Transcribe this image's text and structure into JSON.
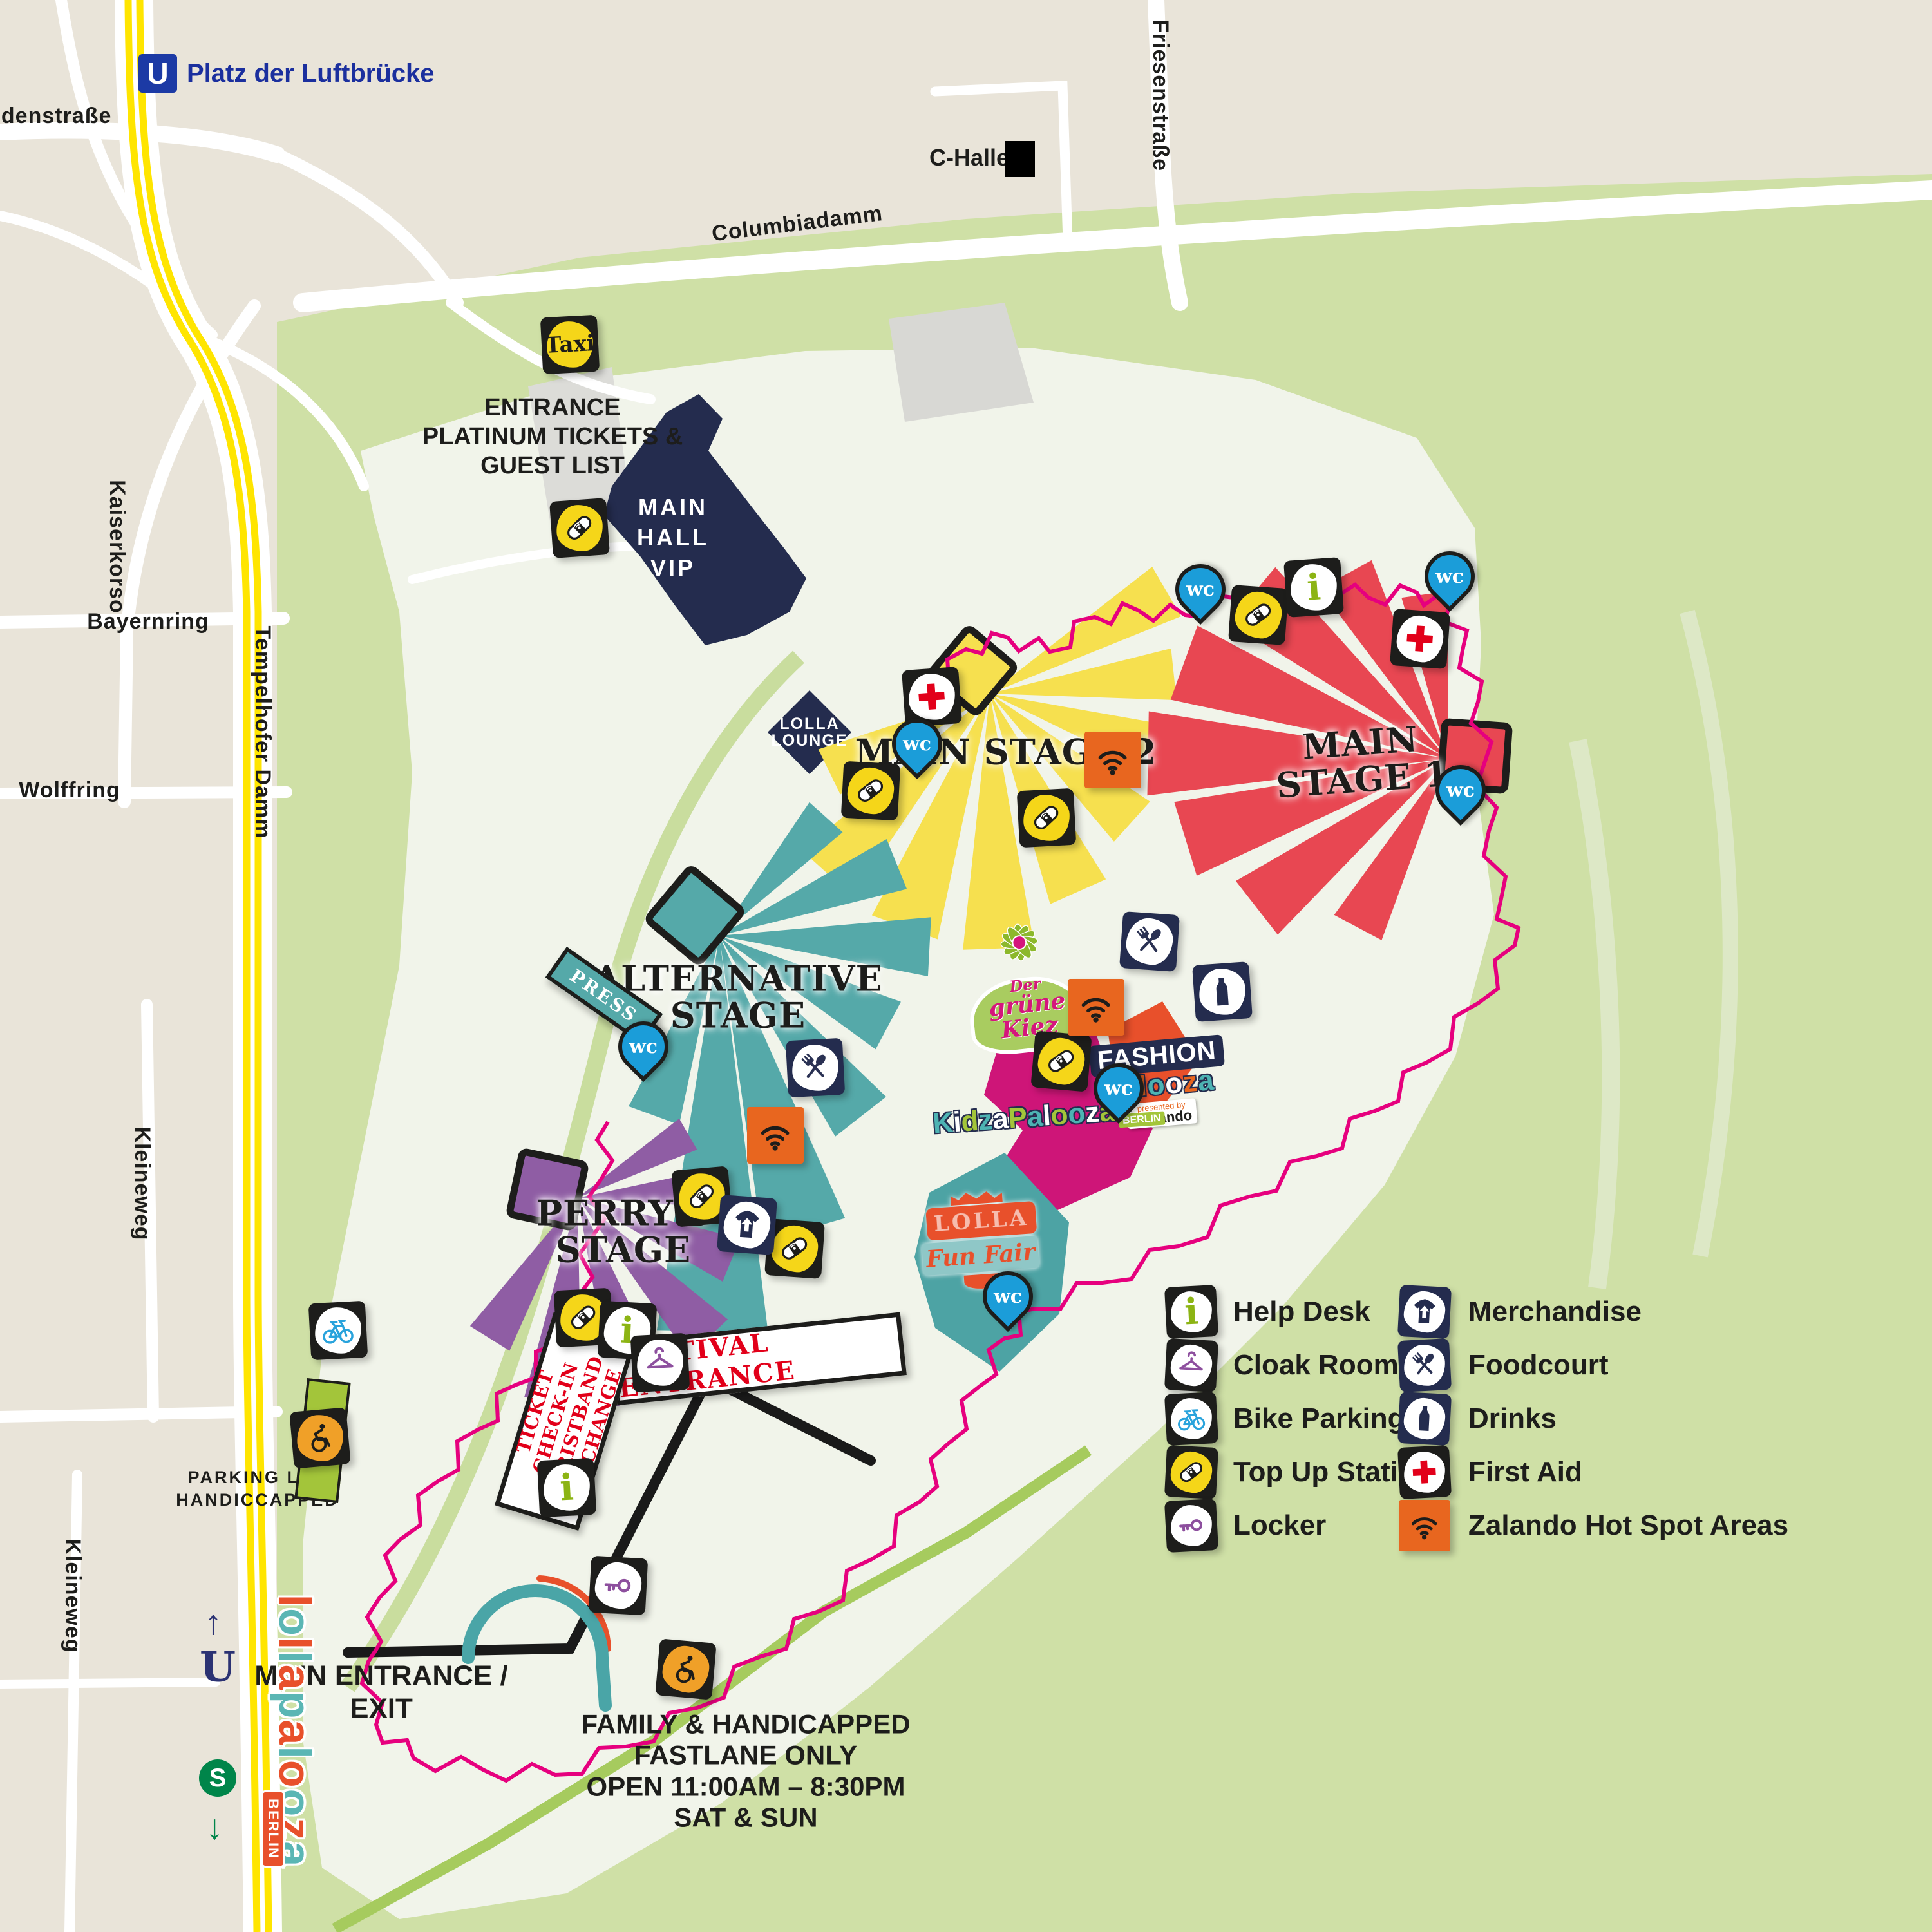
{
  "map": {
    "transit": {
      "u_symbol": "U",
      "u_station": "Platz der Luftbrücke",
      "s_symbol": "S",
      "arrow_up": "↑",
      "arrow_down": "↓"
    },
    "streets": {
      "dudenstrasse": "Dudenstraße",
      "kaiserkorso": "Kaiserkorso",
      "bayernring": "Bayernring",
      "tempelhofer_damm": "Tempelhofer Damm",
      "wolffring": "Wolffring",
      "kleineweg": "Kleineweg",
      "columbiadamm": "Columbiadamm",
      "friesenstrasse": "Friesenstraße"
    },
    "landmarks": {
      "c_halle": "C-Halle",
      "taxi": "Taxi",
      "press": "PRESS",
      "main_hall_vip": [
        "MAIN",
        "HALL",
        "VIP"
      ],
      "lolla_lounge": [
        "LOLLA",
        "LOUNGE"
      ]
    },
    "stages": {
      "main2": "MAIN STAGE 2",
      "main1": [
        "MAIN",
        "STAGE 1"
      ],
      "alternative": [
        "ALTERNATIVE",
        "STAGE"
      ],
      "perrys": [
        "PERRY'S",
        "STAGE"
      ]
    },
    "zones": {
      "gruene_kiez": [
        "Der",
        "grüne",
        "Kiez"
      ],
      "fashion": {
        "line1": "FASHION",
        "line2": "palooza",
        "tag_pre": "presented by",
        "tag_brand": "zalando"
      },
      "kidza": {
        "name": "KidzaPalooza",
        "sub": "BERLIN"
      },
      "funfair": {
        "line1": "LOLLA",
        "line2": "Fun Fair"
      }
    },
    "labels": {
      "entrance_platinum": [
        "ENTRANCE",
        "PLATINUM TICKETS &",
        "GUEST LIST"
      ],
      "festival_entrance": "FESTIVAL ENTRANCE",
      "ticket_checkin": [
        "TICKET",
        "CHECK-IN",
        "WRISTBAND",
        "EXCHANGE"
      ],
      "main_entrance": [
        "MAIN ENTRANCE /",
        "EXIT"
      ],
      "parking": [
        "PARKING LOT",
        "HANDICCAPPED"
      ],
      "fastlane": [
        "FAMILY & HANDICAPPED",
        "FASTLANE ONLY",
        "OPEN 11:00AM – 8:30PM",
        "SAT & SUN"
      ],
      "wc": "wc",
      "info": "i"
    },
    "legend": {
      "items": [
        {
          "icon": "help-desk-icon",
          "label": "Help Desk"
        },
        {
          "icon": "cloak-room-icon",
          "label": "Cloak Room"
        },
        {
          "icon": "bike-parking-icon",
          "label": "Bike Parking"
        },
        {
          "icon": "top-up-station-icon",
          "label": "Top Up Station"
        },
        {
          "icon": "locker-icon",
          "label": "Locker"
        },
        {
          "icon": "merchandise-icon",
          "label": "Merchandise"
        },
        {
          "icon": "foodcourt-icon",
          "label": "Foodcourt"
        },
        {
          "icon": "drinks-icon",
          "label": "Drinks"
        },
        {
          "icon": "first-aid-icon",
          "label": "First Aid"
        },
        {
          "icon": "hotspot-icon",
          "label": "Zalando Hot Spot Areas"
        }
      ]
    },
    "logo": {
      "text": "lollapalooza",
      "sub": "BERLIN"
    },
    "colors": {
      "background_beige": "#e9e4d9",
      "park_green": "#cfe0a6",
      "field_pale": "#f1f4ea",
      "road_yellow": "#ffe500",
      "navy": "#242c4e",
      "ubahn_blue": "#1c3aa5",
      "sbahn_green": "#00854a",
      "stage_main1_red": "#e84752",
      "stage_main2_yellow": "#f6e04f",
      "stage_alt_teal": "#55a9a9",
      "stage_perrys_purple": "#8f5da4",
      "kidza_magenta": "#ce1578",
      "fashion_orange": "#e8502b",
      "hotspot_orange": "#e8661f",
      "boundary_pink": "#e6007e",
      "fastlane_green": "#a6cb5e",
      "first_aid_red": "#e2001a",
      "bike_blue": "#29a3dc",
      "info_green": "#8cb414",
      "cloak_purple": "#8d4f9e",
      "wc_blue": "#1b9dd9"
    }
  }
}
